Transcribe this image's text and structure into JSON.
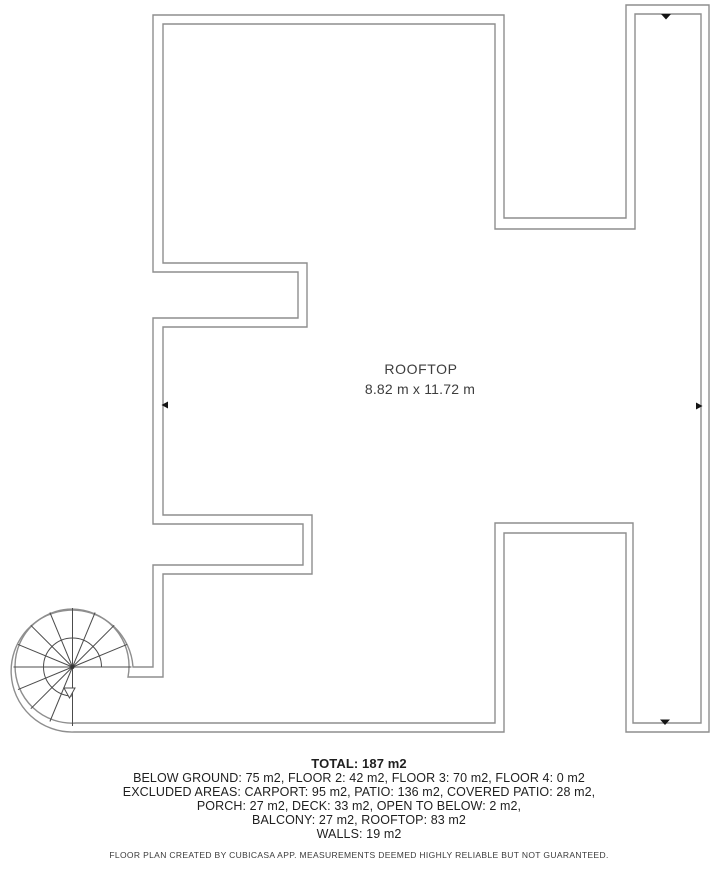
{
  "plan": {
    "room_label": "ROOFTOP",
    "room_dimensions": "8.82 m x 11.72 m"
  },
  "summary": {
    "total": "TOTAL: 187 m2",
    "lines": [
      "BELOW GROUND: 75 m2, FLOOR 2: 42 m2, FLOOR 3: 70 m2, FLOOR 4: 0 m2",
      "EXCLUDED AREAS: CARPORT: 95 m2, PATIO: 136 m2, COVERED PATIO: 28 m2,",
      "PORCH: 27 m2, DECK: 33 m2, OPEN TO BELOW: 2 m2,",
      "BALCONY: 27 m2, ROOFTOP: 83 m2",
      "WALLS: 19 m2"
    ]
  },
  "footer": {
    "disclaimer": "FLOOR PLAN CREATED BY CUBICASA APP. MEASUREMENTS DEEMED HIGHLY RELIABLE BUT NOT GUARANTEED."
  },
  "colors": {
    "wall_line": "#8e8e8e",
    "stair_line": "#4c4c4c",
    "dimension_marker": "#141414",
    "text_primary": "#1f1f1f",
    "text_room_label": "#3d3d3d",
    "background": "#ffffff"
  }
}
